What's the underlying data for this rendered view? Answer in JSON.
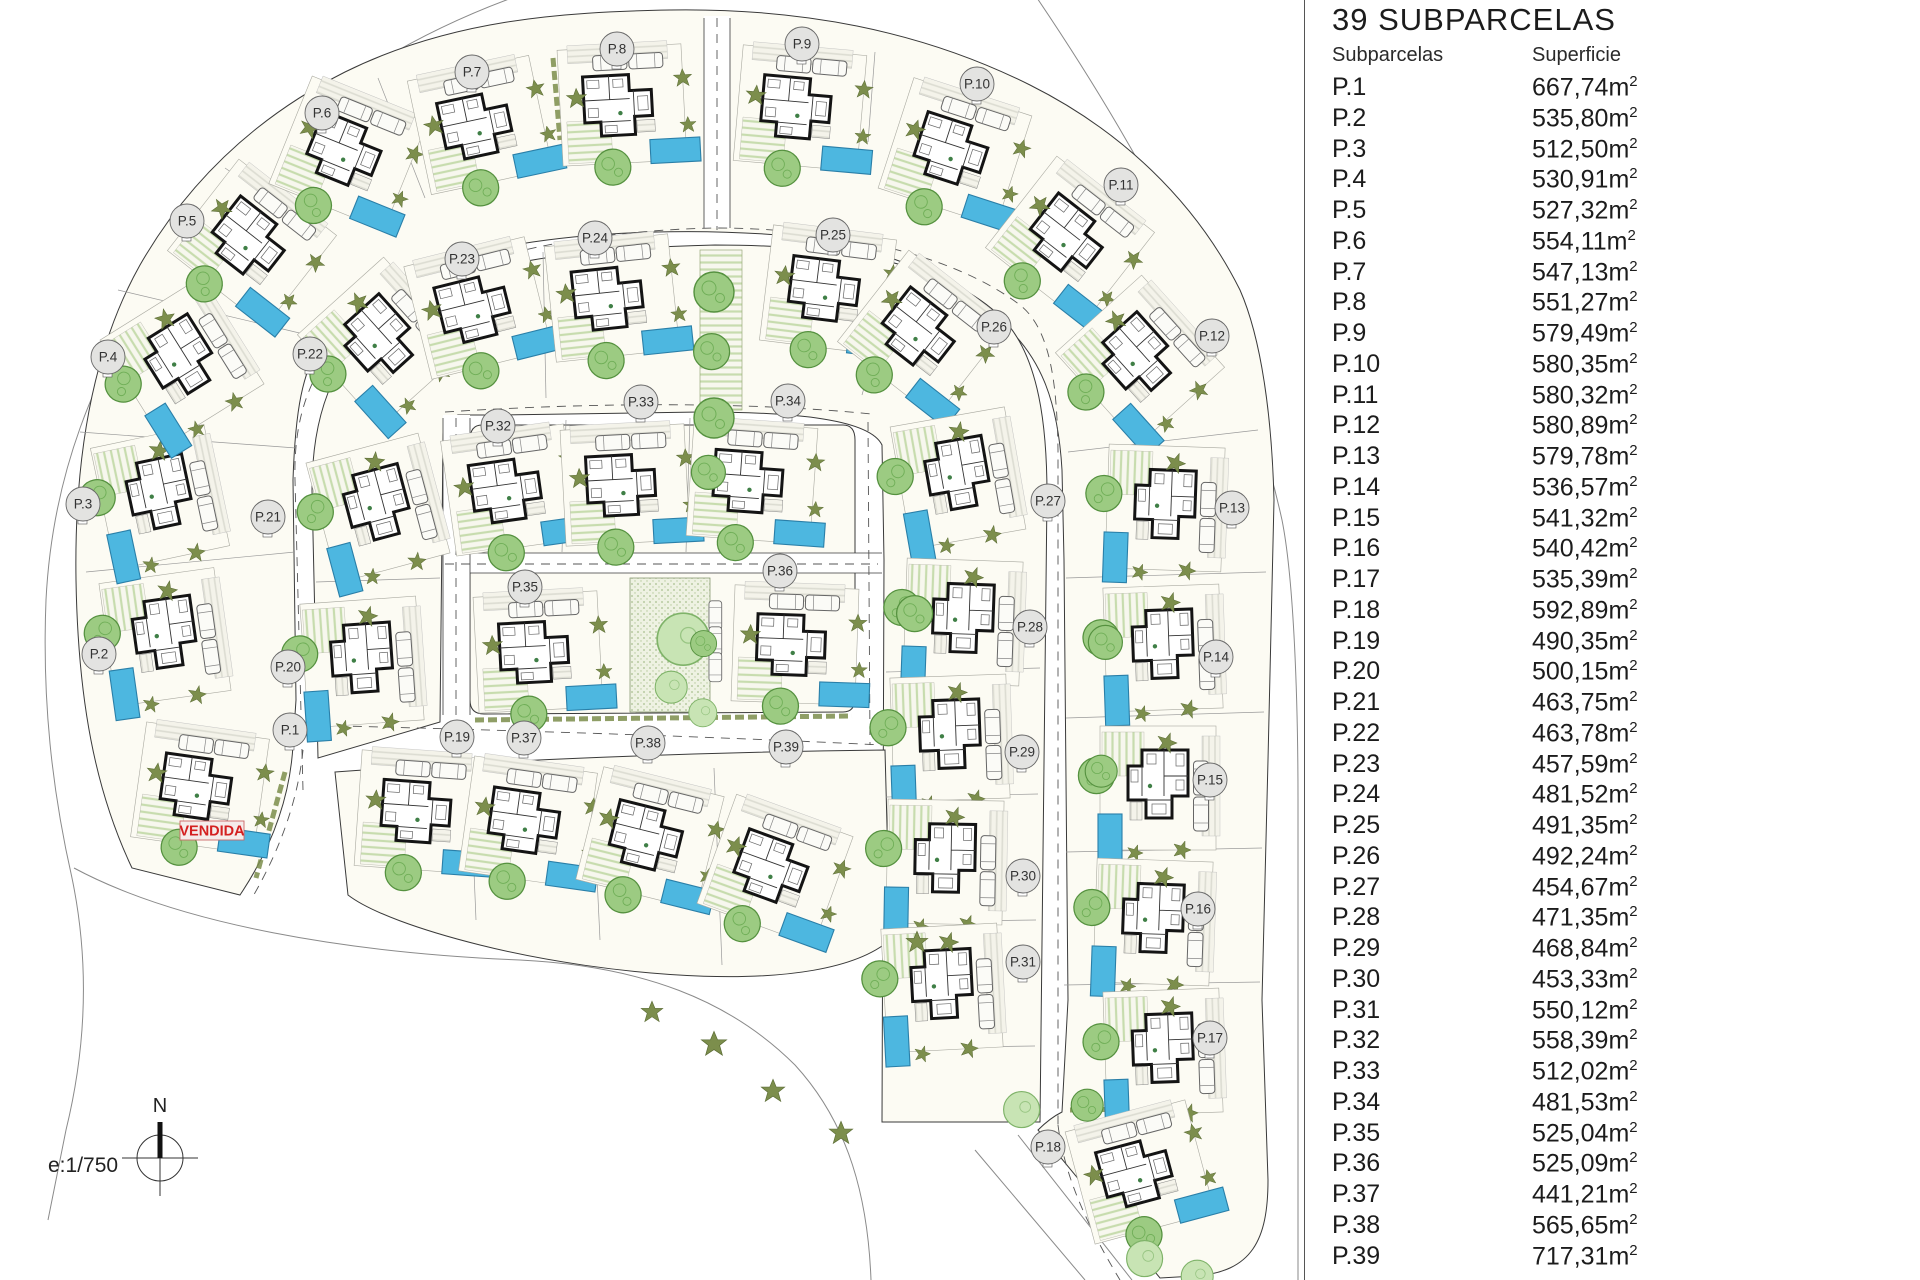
{
  "title": "39 SUBPARCELAS",
  "table": {
    "col1": "Subparcelas",
    "col2": "Superficie",
    "unit_base": "m",
    "unit_sup": "2",
    "rows": [
      {
        "p": "P.1",
        "a": "667,74"
      },
      {
        "p": "P.2",
        "a": "535,80"
      },
      {
        "p": "P.3",
        "a": "512,50"
      },
      {
        "p": "P.4",
        "a": "530,91"
      },
      {
        "p": "P.5",
        "a": "527,32"
      },
      {
        "p": "P.6",
        "a": "554,11"
      },
      {
        "p": "P.7",
        "a": "547,13"
      },
      {
        "p": "P.8",
        "a": "551,27"
      },
      {
        "p": "P.9",
        "a": "579,49"
      },
      {
        "p": "P.10",
        "a": "580,35"
      },
      {
        "p": "P.11",
        "a": "580,32"
      },
      {
        "p": "P.12",
        "a": "580,89"
      },
      {
        "p": "P.13",
        "a": "579,78"
      },
      {
        "p": "P.14",
        "a": "536,57"
      },
      {
        "p": "P.15",
        "a": "541,32"
      },
      {
        "p": "P.16",
        "a": "540,42"
      },
      {
        "p": "P.17",
        "a": "535,39"
      },
      {
        "p": "P.18",
        "a": "592,89"
      },
      {
        "p": "P.19",
        "a": "490,35"
      },
      {
        "p": "P.20",
        "a": "500,15"
      },
      {
        "p": "P.21",
        "a": "463,75"
      },
      {
        "p": "P.22",
        "a": "463,78"
      },
      {
        "p": "P.23",
        "a": "457,59"
      },
      {
        "p": "P.24",
        "a": "481,52"
      },
      {
        "p": "P.25",
        "a": "491,35"
      },
      {
        "p": "P.26",
        "a": "492,24"
      },
      {
        "p": "P.27",
        "a": "454,67"
      },
      {
        "p": "P.28",
        "a": "471,35"
      },
      {
        "p": "P.29",
        "a": "468,84"
      },
      {
        "p": "P.30",
        "a": "453,33"
      },
      {
        "p": "P.31",
        "a": "550,12"
      },
      {
        "p": "P.32",
        "a": "558,39"
      },
      {
        "p": "P.33",
        "a": "512,02"
      },
      {
        "p": "P.34",
        "a": "481,53"
      },
      {
        "p": "P.35",
        "a": "525,04"
      },
      {
        "p": "P.36",
        "a": "525,09"
      },
      {
        "p": "P.37",
        "a": "441,21"
      },
      {
        "p": "P.38",
        "a": "565,65"
      },
      {
        "p": "P.39",
        "a": "717,31"
      }
    ]
  },
  "plan": {
    "vendida": "VENDIDA",
    "scale": "e:1/750",
    "north": "N",
    "plots": [
      {
        "label": "P.1",
        "x": 290,
        "y": 730
      },
      {
        "label": "P.2",
        "x": 99,
        "y": 654
      },
      {
        "label": "P.3",
        "x": 83,
        "y": 504
      },
      {
        "label": "P.4",
        "x": 108,
        "y": 357
      },
      {
        "label": "P.5",
        "x": 187,
        "y": 221
      },
      {
        "label": "P.6",
        "x": 322,
        "y": 113
      },
      {
        "label": "P.7",
        "x": 472,
        "y": 72
      },
      {
        "label": "P.8",
        "x": 617,
        "y": 49
      },
      {
        "label": "P.9",
        "x": 802,
        "y": 44
      },
      {
        "label": "P.10",
        "x": 977,
        "y": 84
      },
      {
        "label": "P.11",
        "x": 1121,
        "y": 185
      },
      {
        "label": "P.12",
        "x": 1212,
        "y": 336
      },
      {
        "label": "P.13",
        "x": 1232,
        "y": 508
      },
      {
        "label": "P.14",
        "x": 1216,
        "y": 657
      },
      {
        "label": "P.15",
        "x": 1210,
        "y": 780
      },
      {
        "label": "P.16",
        "x": 1198,
        "y": 909
      },
      {
        "label": "P.17",
        "x": 1210,
        "y": 1038
      },
      {
        "label": "P.18",
        "x": 1048,
        "y": 1147
      },
      {
        "label": "P.19",
        "x": 457,
        "y": 737
      },
      {
        "label": "P.20",
        "x": 288,
        "y": 667
      },
      {
        "label": "P.21",
        "x": 268,
        "y": 517
      },
      {
        "label": "P.22",
        "x": 310,
        "y": 354
      },
      {
        "label": "P.23",
        "x": 462,
        "y": 259
      },
      {
        "label": "P.24",
        "x": 595,
        "y": 238
      },
      {
        "label": "P.25",
        "x": 833,
        "y": 235
      },
      {
        "label": "P.26",
        "x": 994,
        "y": 327
      },
      {
        "label": "P.27",
        "x": 1048,
        "y": 501
      },
      {
        "label": "P.28",
        "x": 1030,
        "y": 627
      },
      {
        "label": "P.29",
        "x": 1022,
        "y": 752
      },
      {
        "label": "P.30",
        "x": 1023,
        "y": 876
      },
      {
        "label": "P.31",
        "x": 1023,
        "y": 962
      },
      {
        "label": "P.32",
        "x": 498,
        "y": 426
      },
      {
        "label": "P.33",
        "x": 641,
        "y": 402
      },
      {
        "label": "P.34",
        "x": 788,
        "y": 401
      },
      {
        "label": "P.35",
        "x": 525,
        "y": 587
      },
      {
        "label": "P.36",
        "x": 780,
        "y": 571
      },
      {
        "label": "P.37",
        "x": 524,
        "y": 738
      },
      {
        "label": "P.38",
        "x": 648,
        "y": 743
      },
      {
        "label": "P.39",
        "x": 786,
        "y": 747
      }
    ],
    "villas": [
      {
        "x": 200,
        "y": 788,
        "r": 8
      },
      {
        "x": 165,
        "y": 637,
        "r": 82
      },
      {
        "x": 160,
        "y": 497,
        "r": 78
      },
      {
        "x": 182,
        "y": 362,
        "r": 58
      },
      {
        "x": 252,
        "y": 243,
        "r": 38
      },
      {
        "x": 348,
        "y": 153,
        "r": 22
      },
      {
        "x": 480,
        "y": 125,
        "r": -12
      },
      {
        "x": 622,
        "y": 105,
        "r": -3
      },
      {
        "x": 800,
        "y": 108,
        "r": 5
      },
      {
        "x": 955,
        "y": 152,
        "r": 18
      },
      {
        "x": 1070,
        "y": 240,
        "r": 38
      },
      {
        "x": 1140,
        "y": 360,
        "r": 48
      },
      {
        "x": 1165,
        "y": 508,
        "r": 92
      },
      {
        "x": 1163,
        "y": 648,
        "r": 88
      },
      {
        "x": 1158,
        "y": 788,
        "r": 90
      },
      {
        "x": 1153,
        "y": 922,
        "r": 92
      },
      {
        "x": 1163,
        "y": 1052,
        "r": 88
      },
      {
        "x": 1140,
        "y": 1172,
        "r": -15
      },
      {
        "x": 420,
        "y": 812,
        "r": 4
      },
      {
        "x": 362,
        "y": 662,
        "r": 86
      },
      {
        "x": 378,
        "y": 508,
        "r": 75
      },
      {
        "x": 382,
        "y": 342,
        "r": 48
      },
      {
        "x": 478,
        "y": 308,
        "r": -14
      },
      {
        "x": 612,
        "y": 298,
        "r": -6
      },
      {
        "x": 828,
        "y": 290,
        "r": 7
      },
      {
        "x": 922,
        "y": 334,
        "r": 38
      },
      {
        "x": 958,
        "y": 478,
        "r": 80
      },
      {
        "x": 963,
        "y": 622,
        "r": 92
      },
      {
        "x": 950,
        "y": 738,
        "r": 88
      },
      {
        "x": 945,
        "y": 862,
        "r": 91
      },
      {
        "x": 942,
        "y": 988,
        "r": 87
      },
      {
        "x": 510,
        "y": 490,
        "r": -8
      },
      {
        "x": 625,
        "y": 485,
        "r": -3
      },
      {
        "x": 752,
        "y": 482,
        "r": 4
      },
      {
        "x": 538,
        "y": 652,
        "r": -3
      },
      {
        "x": 795,
        "y": 645,
        "r": 2
      },
      {
        "x": 528,
        "y": 822,
        "r": 8
      },
      {
        "x": 650,
        "y": 838,
        "r": 14
      },
      {
        "x": 775,
        "y": 870,
        "r": 20
      }
    ],
    "trees": [
      {
        "x": 690,
        "y": 268,
        "k": "t",
        "s": 1.0
      },
      {
        "x": 690,
        "y": 330,
        "k": "t",
        "s": 0.9
      },
      {
        "x": 690,
        "y": 394,
        "k": "t",
        "s": 1.0
      },
      {
        "x": 688,
        "y": 452,
        "k": "t",
        "s": 0.85
      },
      {
        "x": 652,
        "y": 608,
        "k": "l",
        "s": 1.3
      },
      {
        "x": 688,
        "y": 628,
        "k": "t",
        "s": 0.65
      },
      {
        "x": 652,
        "y": 668,
        "k": "l",
        "s": 0.8
      },
      {
        "x": 686,
        "y": 696,
        "k": "l",
        "s": 0.7
      },
      {
        "x": 893,
        "y": 592,
        "k": "t",
        "s": 0.9
      },
      {
        "x": 1085,
        "y": 622,
        "k": "t",
        "s": 0.85
      },
      {
        "x": 1082,
        "y": 752,
        "k": "t",
        "s": 0.8
      },
      {
        "x": 1000,
        "y": 1088,
        "k": "l",
        "s": 0.9
      },
      {
        "x": 1068,
        "y": 1086,
        "k": "t",
        "s": 0.8
      },
      {
        "x": 1123,
        "y": 1237,
        "k": "l",
        "s": 0.9
      },
      {
        "x": 1178,
        "y": 1257,
        "k": "l",
        "s": 0.8
      },
      {
        "x": 700,
        "y": 1030,
        "k": "b",
        "s": 1.4
      },
      {
        "x": 760,
        "y": 1078,
        "k": "b",
        "s": 1.3
      },
      {
        "x": 640,
        "y": 1000,
        "k": "b",
        "s": 1.2
      },
      {
        "x": 828,
        "y": 1120,
        "k": "b",
        "s": 1.3
      },
      {
        "x": 905,
        "y": 930,
        "k": "b",
        "s": 1.2
      }
    ]
  },
  "colors": {
    "pool": "#4db7e0",
    "pool_edge": "#2a7fa8",
    "tree": "#9ccb82",
    "tree_edge": "#55913f",
    "light_tree": "#c8e4b4",
    "bush": "#7c8e4c",
    "parcel": "#fcfbf3",
    "vendida_red": "#d42020"
  }
}
